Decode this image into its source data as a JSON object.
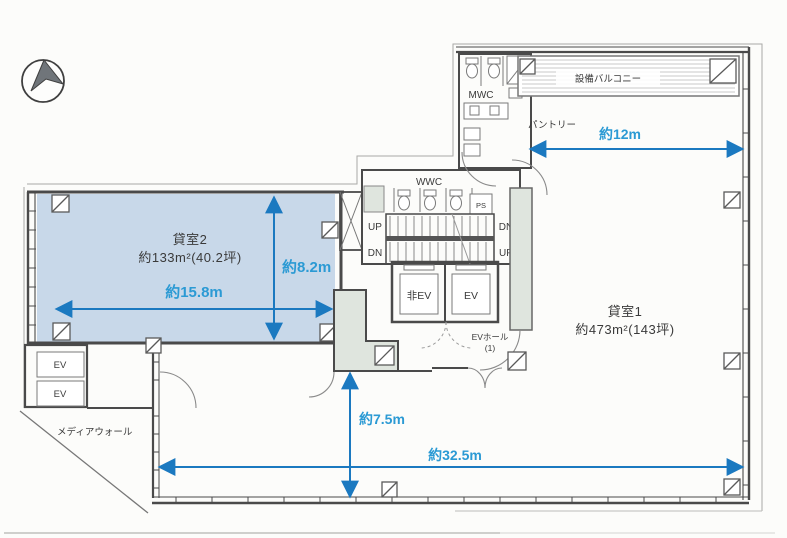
{
  "plan": {
    "rooms": {
      "room2_name": "貸室2",
      "room2_area": "約133m²(40.2坪)",
      "room1_name": "貸室1",
      "room1_area": "約473m²(143坪)"
    },
    "core": {
      "mwc": "MWC",
      "wwc": "WWC",
      "ps": "PS",
      "up_left": "UP",
      "dn_right": "DN",
      "dn_left": "DN",
      "up_right": "UP",
      "ev_emergency": "非EV",
      "ev": "EV",
      "ev_hall_line1": "EVホール",
      "ev_hall_line2": "(1)",
      "pantry": "パントリー",
      "balcony": "設備バルコニー"
    },
    "west": {
      "ev1": "EV",
      "ev2": "EV",
      "media_wall": "メディアウォール"
    },
    "dimensions": {
      "top": "約12m",
      "room2_width": "約15.8m",
      "room2_depth": "約8.2m",
      "south_depth": "約7.5m",
      "south_width": "約32.5m"
    },
    "icons": {
      "compass": "north-arrow"
    },
    "colors": {
      "dimension_text": "#2b9ad4",
      "dimension_arrow": "#1b79c0",
      "room2_fill": "#c8d8e9",
      "wall": "#4a4a4a",
      "core_tint": "#dfe5de"
    }
  }
}
